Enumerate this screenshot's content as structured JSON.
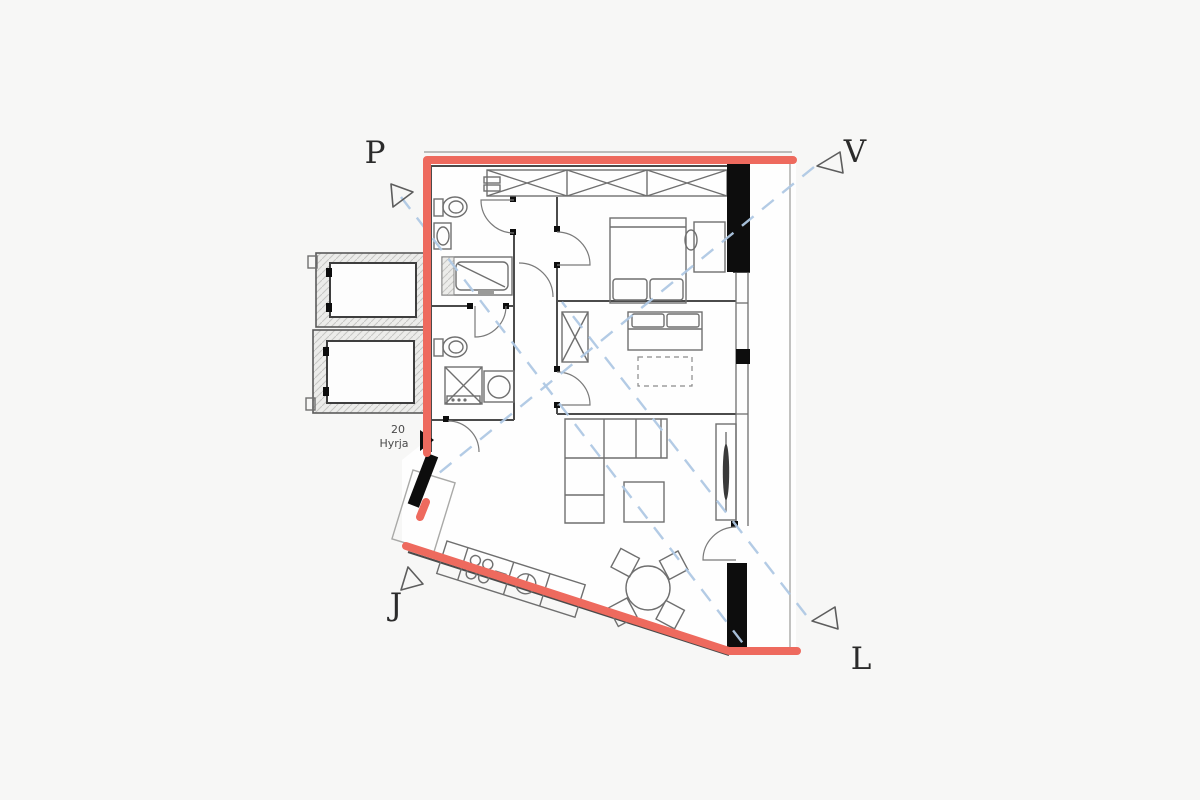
{
  "document": {
    "type": "apartment floor plan drawing"
  },
  "labels": {
    "p": "P",
    "v": "V",
    "j": "J",
    "l": "L"
  },
  "entrance": {
    "number": "20",
    "label": "Hyrja"
  },
  "colors": {
    "background": "#f7f7f6",
    "boundary": "#ee6a5e",
    "walls": "#4b4b4b",
    "column": "#0d0d0d",
    "sightline": "#afc8e4",
    "text": "#2b2b2b"
  }
}
